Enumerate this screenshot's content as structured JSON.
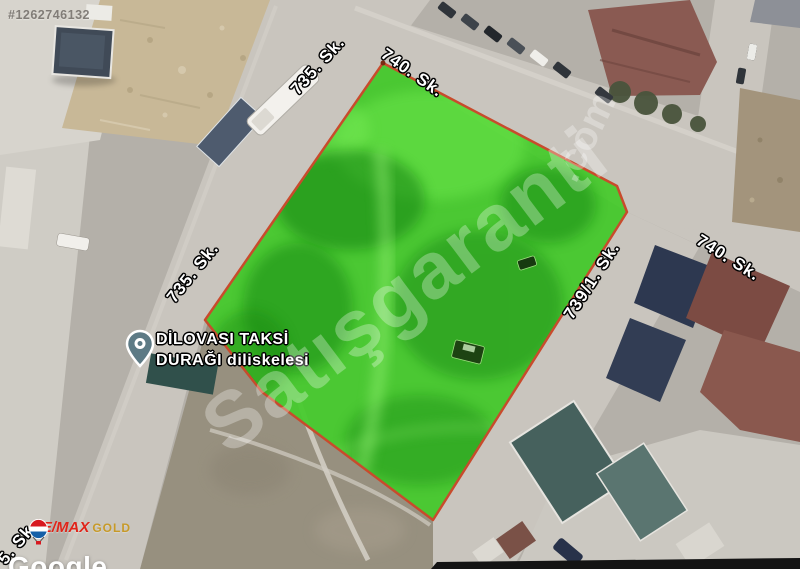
{
  "listing": {
    "id": "#1262746132"
  },
  "map": {
    "street_labels": [
      {
        "text": "735. Sk."
      },
      {
        "text": "740. Sk."
      },
      {
        "text": "735. Sk."
      },
      {
        "text": "739/1. Sk."
      },
      {
        "text": "740. Sk."
      },
      {
        "text": "5. Sk."
      }
    ],
    "poi": {
      "name_line1": "DİLOVASI TAKSİ",
      "name_line2": "DURAĞI diliskelesi",
      "icon": "map-pin-icon",
      "pin_color": "#5d7a85"
    },
    "attribution": "Google"
  },
  "parcel": {
    "fill_color": "#3ccb22",
    "border_color": "#c84b2c"
  },
  "watermarks": {
    "brand": "Satışgaranti",
    "brand_suffix": ".com"
  },
  "branding": {
    "agency_name": "RE/MAX",
    "agency_suffix": "GOLD",
    "icon": "remax-balloon-icon"
  },
  "colors": {
    "road": "#c9c5be",
    "ground": "#b4b0a9",
    "dirt": "#97907f",
    "sand": "#c8b897"
  }
}
